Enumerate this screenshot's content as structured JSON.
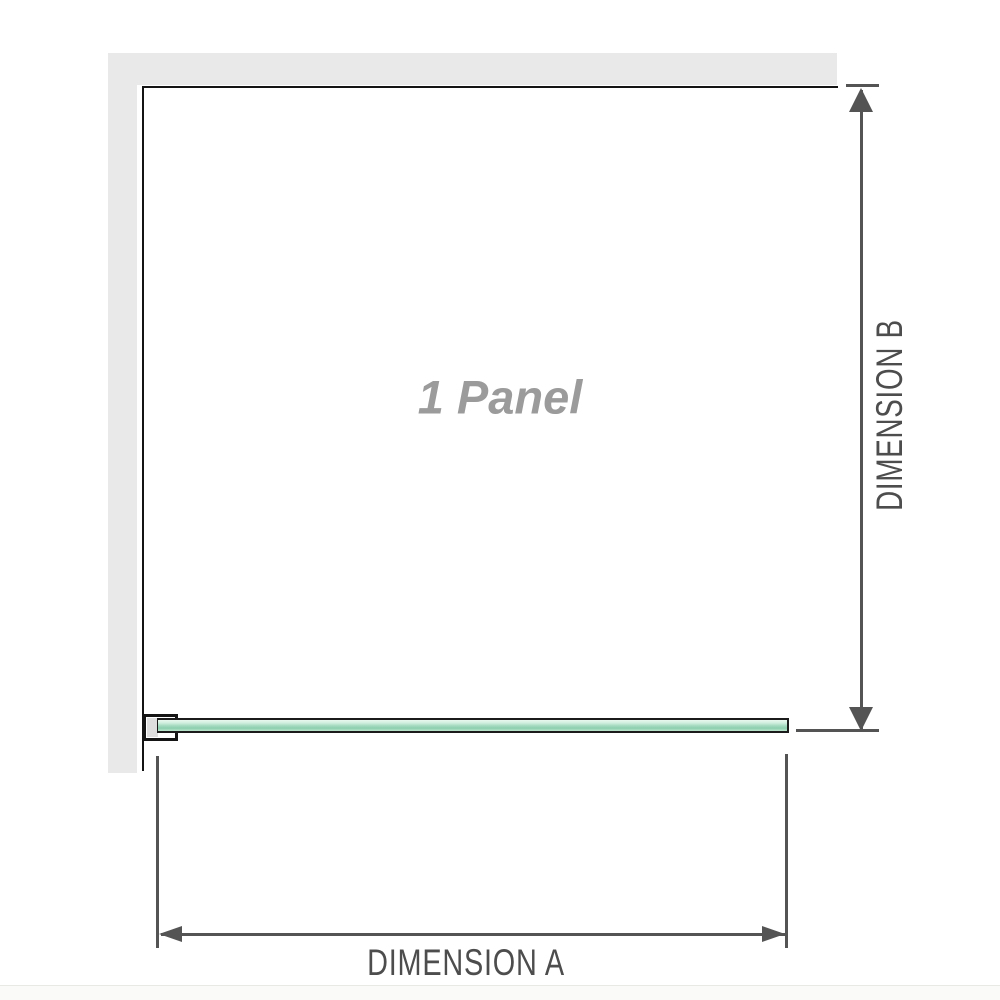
{
  "diagram": {
    "panel_label": "1 Panel",
    "dimension_a_label": "DIMENSION A",
    "dimension_b_label": "DIMENSION B"
  },
  "colors": {
    "wall_fill": "#e9e9e9",
    "line_black": "#141414",
    "dimension_color": "#545454",
    "dimension_text": "#4d4d4d",
    "glass_border": "#1b1b1b",
    "glass_light": "#e9f8ef",
    "glass_soft": "#cfeede",
    "glass_mid": "#a5dabf",
    "glass_dark": "#8ccfae",
    "glass_soft2": "#bce5cd",
    "panel_label_color": "#9b9b9b",
    "bracket_fill": "#ffffff",
    "bracket_inner": "#dedede",
    "baseline_line": "#e8e8e5",
    "below_bg": "#fafaf8"
  }
}
